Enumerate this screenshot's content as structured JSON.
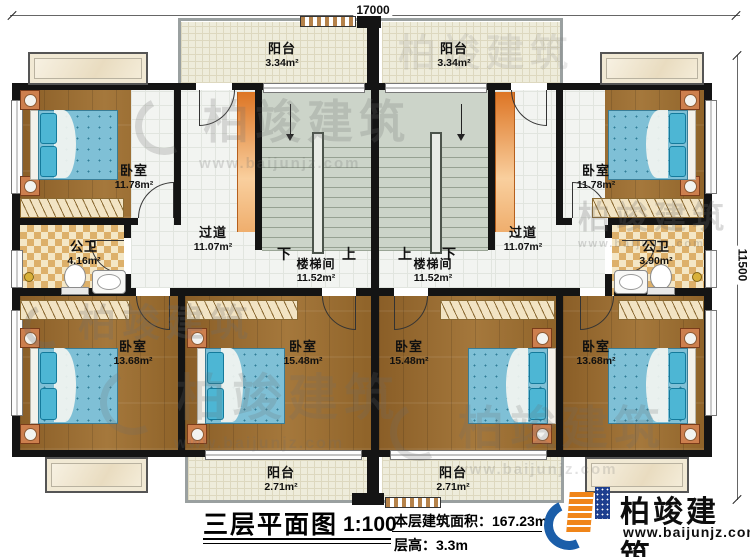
{
  "dimensions": {
    "width_label": "17000",
    "height_label": "11500"
  },
  "rooms": {
    "balcony_tl": {
      "name": "阳台",
      "area": "3.34m²"
    },
    "balcony_tr": {
      "name": "阳台",
      "area": "3.34m²"
    },
    "bedroom_tl": {
      "name": "卧室",
      "area": "11.78m²"
    },
    "bedroom_tr": {
      "name": "卧室",
      "area": "11.78m²"
    },
    "bath_l": {
      "name": "公卫",
      "area": "4.16m²"
    },
    "bath_r": {
      "name": "公卫",
      "area": "3.90m²"
    },
    "hall_l": {
      "name": "过道",
      "area": "11.07m²"
    },
    "hall_r": {
      "name": "过道",
      "area": "11.07m²"
    },
    "stair_l": {
      "name": "楼梯间",
      "area": "11.52m²",
      "down": "下",
      "up": "上"
    },
    "stair_r": {
      "name": "楼梯间",
      "area": "11.52m²",
      "down": "下",
      "up": "上"
    },
    "bedroom_b1": {
      "name": "卧室",
      "area": "13.68m²"
    },
    "bedroom_b2": {
      "name": "卧室",
      "area": "15.48m²"
    },
    "bedroom_b3": {
      "name": "卧室",
      "area": "15.48m²"
    },
    "bedroom_b4": {
      "name": "卧室",
      "area": "13.68m²"
    },
    "balcony_bl": {
      "name": "阳台",
      "area": "2.71m²"
    },
    "balcony_br": {
      "name": "阳台",
      "area": "2.71m²"
    }
  },
  "footer": {
    "title": "三层平面图",
    "scale": "1:100",
    "area_label": "本层建筑面积：",
    "area_value": "167.23m²",
    "height_label": "层高：",
    "height_value": "3.3m"
  },
  "logo": {
    "name": "柏竣建筑",
    "url": "www.baijunjz.com"
  },
  "watermark": {
    "name": "柏竣建筑",
    "url": "www.baijunjz.com"
  },
  "colors": {
    "wall": "#141414",
    "wood_floor": "#9a6c30",
    "mattress_blue": "#7fc0d6",
    "accent_orange": "#dd7524",
    "logo_blue": "#1b5ea9",
    "logo_orange": "#f08519"
  }
}
